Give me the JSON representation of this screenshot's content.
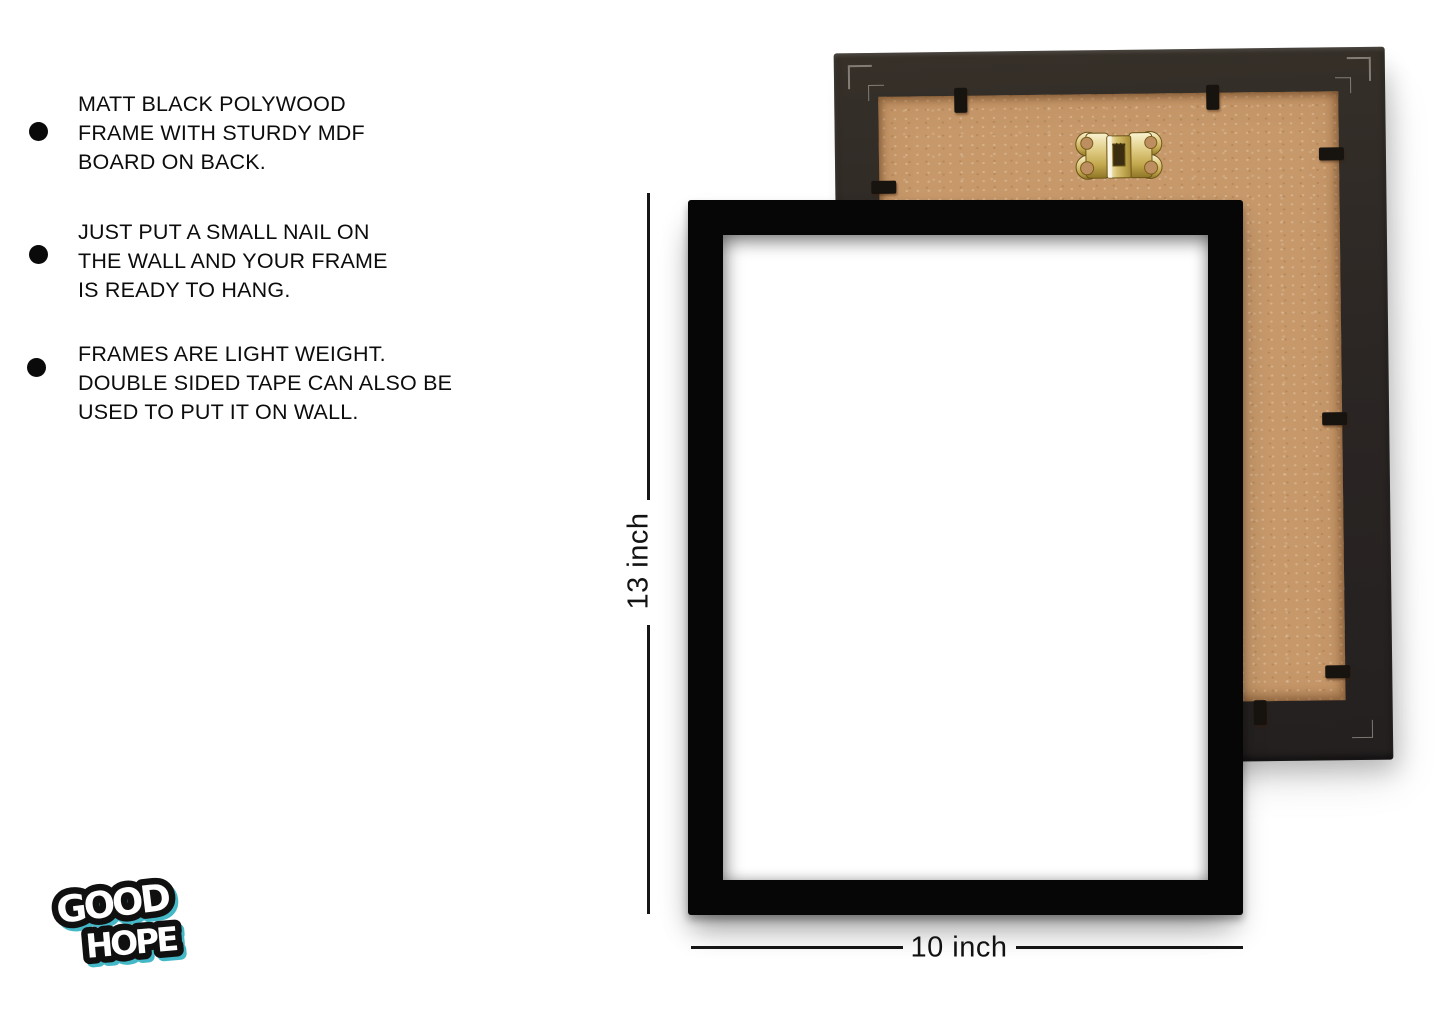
{
  "features": {
    "items": [
      {
        "lines": [
          "MATT BLACK POLYWOOD",
          "FRAME WITH STURDY MDF",
          "BOARD ON BACK."
        ]
      },
      {
        "lines": [
          "JUST PUT A SMALL NAIL ON",
          "THE WALL AND YOUR FRAME",
          "IS READY TO HANG."
        ]
      },
      {
        "lines": [
          "FRAMES ARE LIGHT WEIGHT.",
          "DOUBLE SIDED TAPE CAN ALSO BE",
          "USED TO PUT IT ON WALL."
        ]
      }
    ]
  },
  "dimensions": {
    "height_label": "13 inch",
    "width_label": "10 inch"
  },
  "logo": {
    "word1": "GOOD",
    "word2": "HOPE"
  },
  "colors": {
    "background": "#ffffff",
    "text": "#0c0c0c",
    "front_frame_black": "#060606",
    "back_frame_charcoal": "#2b2624",
    "mdf_board_tan": "#c6986a",
    "hook_brass": "#d9c176",
    "clip_black": "#17130f",
    "logo_accent_cyan": "#45b8c8"
  }
}
